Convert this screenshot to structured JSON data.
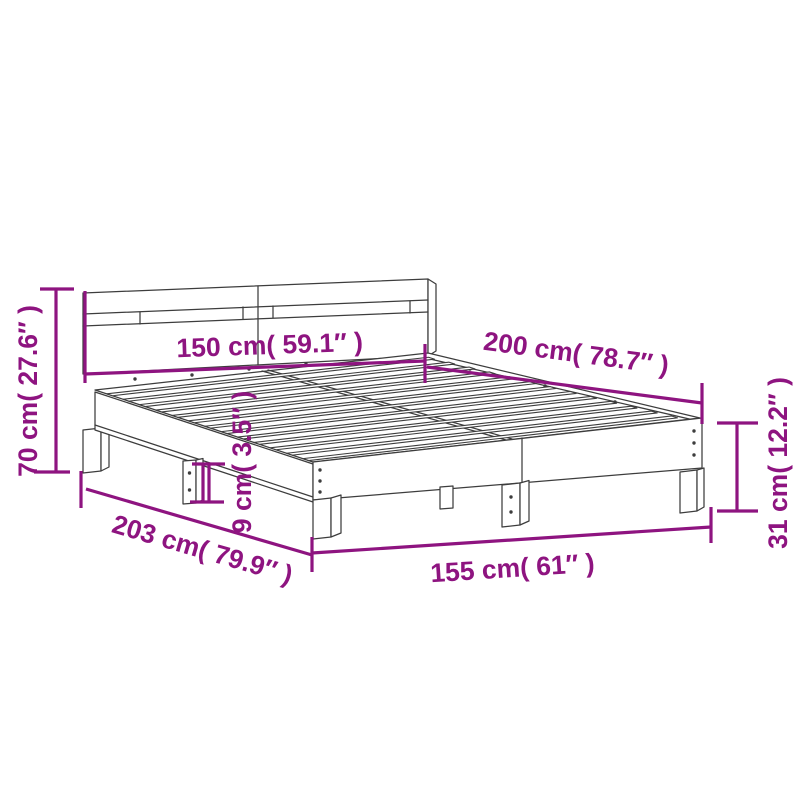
{
  "diagram": {
    "name": "bed-frame-dimension-diagram",
    "accent_color": "#8E1480",
    "line_color": "#3D3D3D",
    "background_color": "#FFFFFF"
  },
  "labels": {
    "dim_150": "150 cm( 59.1″ )",
    "dim_200": "200 cm( 78.7″ )",
    "dim_70": "70 cm( 27.6″ )",
    "dim_31": "31 cm( 12.2″ )",
    "dim_203": "203 cm( 79.9″ )",
    "dim_155": "155 cm( 61″ )",
    "dim_9": "9 cm( 3.5″ )"
  }
}
